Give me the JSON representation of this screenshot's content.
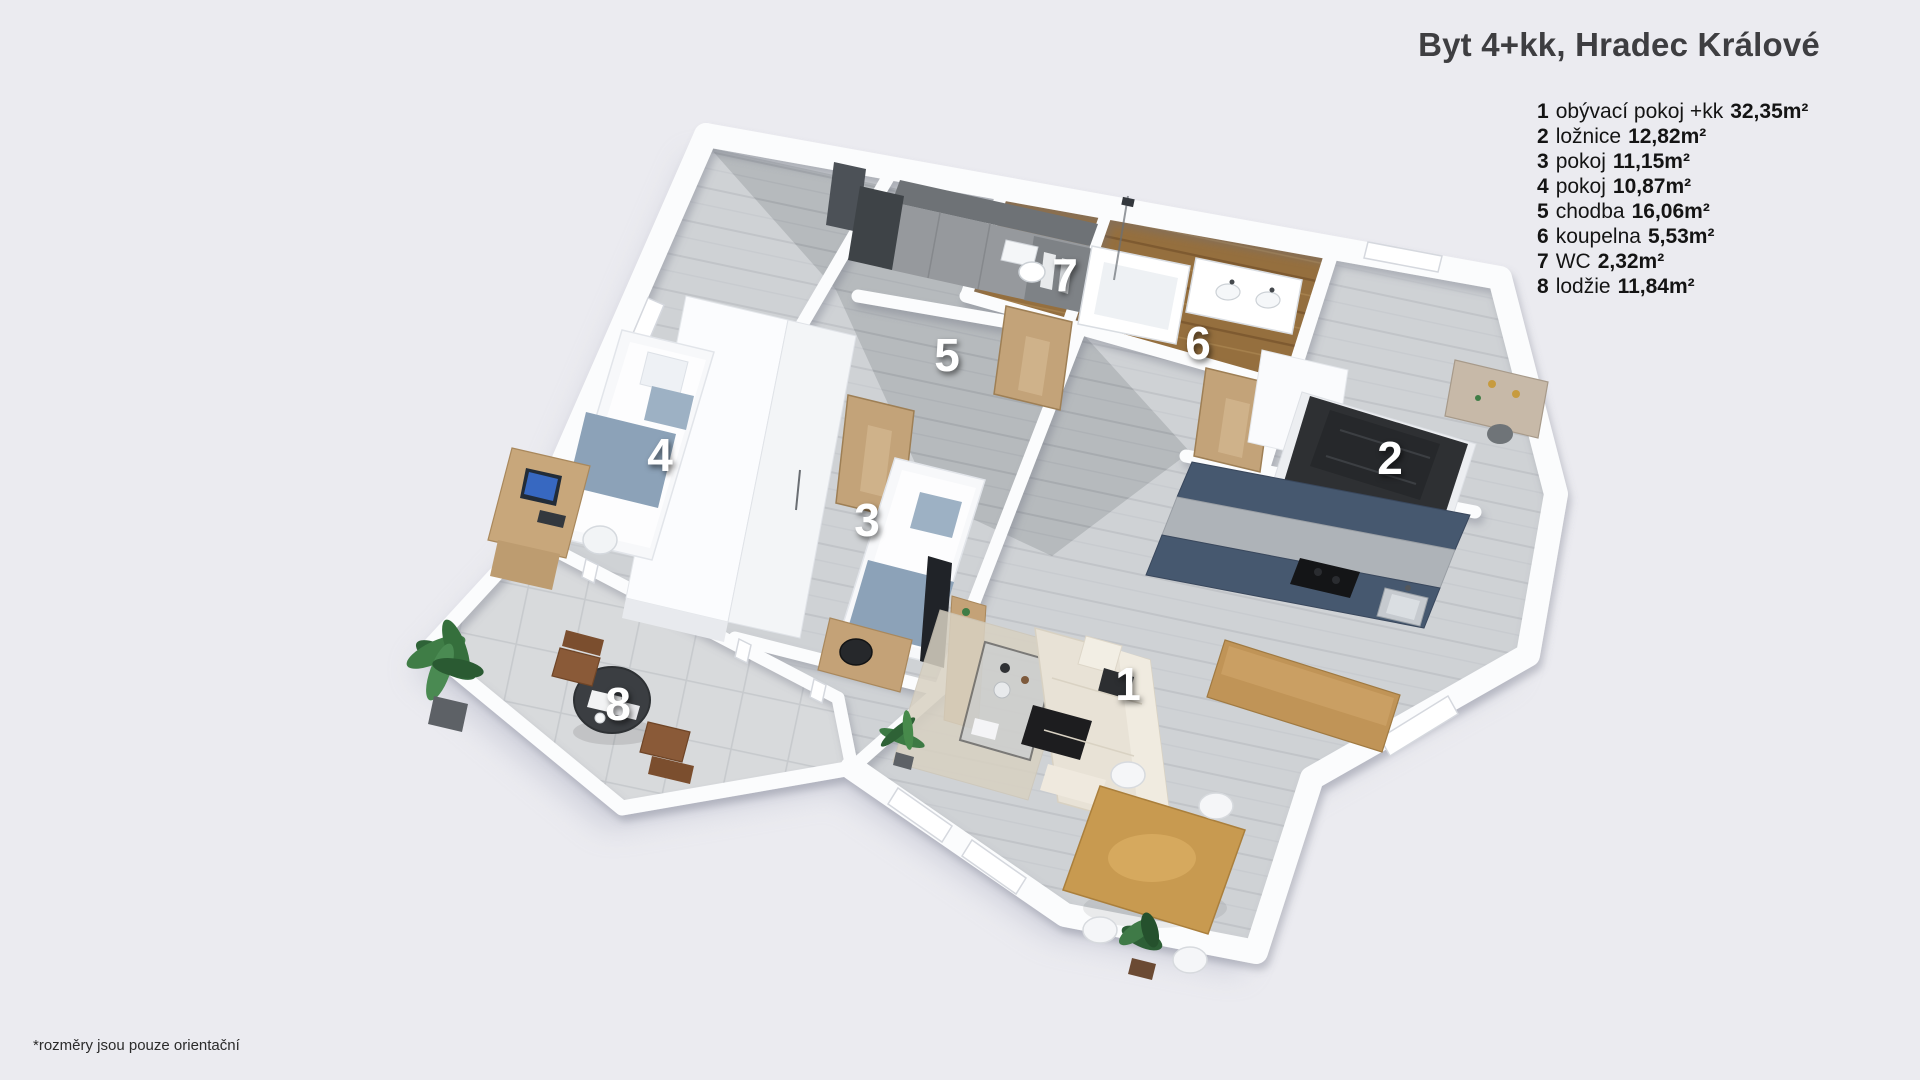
{
  "title": "Byt 4+kk, Hradec Králové",
  "legend": {
    "items": [
      {
        "num": "1",
        "name": "obývací pokoj +kk",
        "area": "32,35m²"
      },
      {
        "num": "2",
        "name": "ložnice",
        "area": "12,82m²"
      },
      {
        "num": "3",
        "name": "pokoj",
        "area": "11,15m²"
      },
      {
        "num": "4",
        "name": "pokoj",
        "area": "10,87m²"
      },
      {
        "num": "5",
        "name": "chodba",
        "area": "16,06m²"
      },
      {
        "num": "6",
        "name": "koupelna",
        "area": "5,53m²"
      },
      {
        "num": "7",
        "name": "WC",
        "area": "2,32m²"
      },
      {
        "num": "8",
        "name": "lodžie",
        "area": "11,84m²"
      }
    ]
  },
  "footnote": "*rozměry jsou pouze orientační",
  "plan": {
    "room_labels": [
      {
        "num": "1",
        "x": 1128,
        "y": 700
      },
      {
        "num": "2",
        "x": 1390,
        "y": 474
      },
      {
        "num": "3",
        "x": 867,
        "y": 536
      },
      {
        "num": "4",
        "x": 660,
        "y": 471
      },
      {
        "num": "5",
        "x": 947,
        "y": 371
      },
      {
        "num": "6",
        "x": 1198,
        "y": 359
      },
      {
        "num": "7",
        "x": 1065,
        "y": 291
      },
      {
        "num": "8",
        "x": 618,
        "y": 720
      }
    ]
  },
  "colors": {
    "background": "#ebebf0",
    "title_text": "#3e3e41",
    "legend_text": "#141414",
    "room_label_text": "#ffffff",
    "wall_white": "#fbfcfd",
    "floor_light_wood": "#cfd2d5",
    "floor_hall_wood": "#b6babd",
    "floor_bath_wood": "#956f3e",
    "floor_loggia_tile": "#d8dadc",
    "kitchen_navy": "#46586f",
    "door_oak": "#c3a379",
    "bed_dark": "#2e3033",
    "sofa_cream": "#e8e2d6",
    "plant_green": "#3f7d46"
  }
}
